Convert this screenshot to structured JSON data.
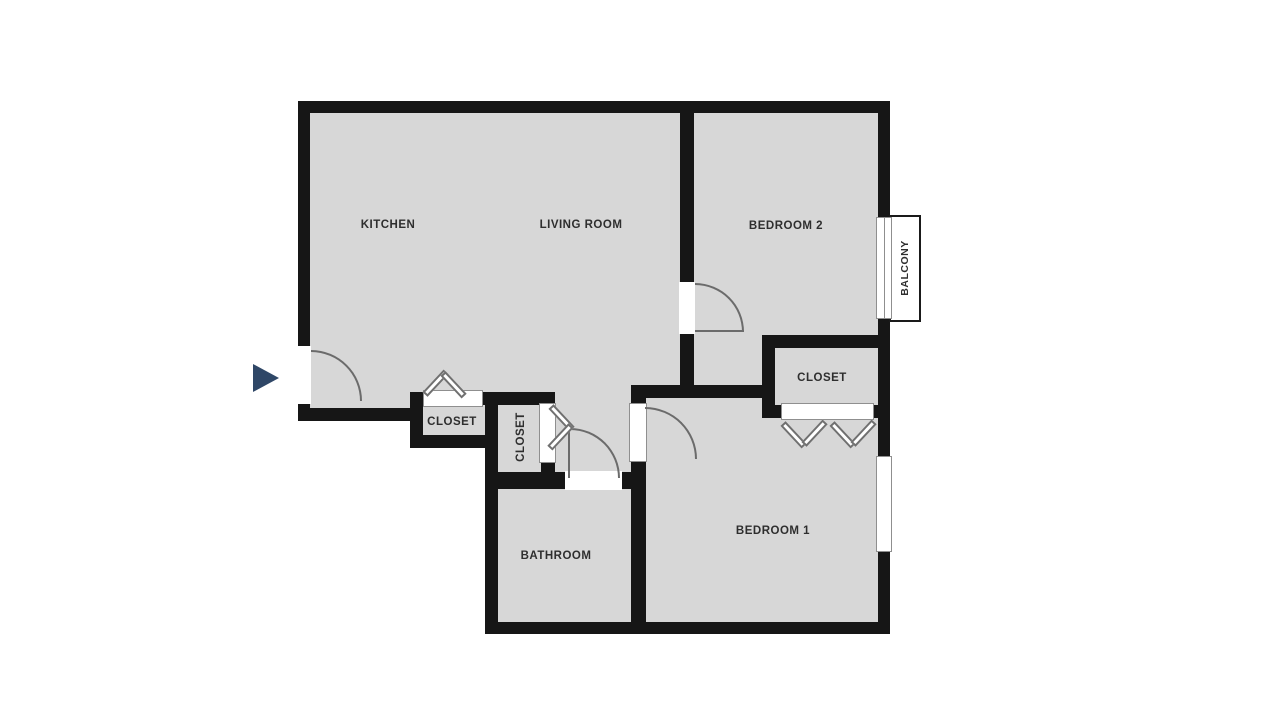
{
  "floor_plan": {
    "type": "apartment-floor-plan",
    "colors": {
      "background": "#ffffff",
      "wall": "#161616",
      "floor": "#d7d7d7",
      "door_arc": "#6b6b6b",
      "opening_outline": "#8f8f8f",
      "entry_arrow": "#2f4767",
      "label_text": "#2e2e2e"
    },
    "labels": {
      "kitchen": "KITCHEN",
      "living_room": "LIVING ROOM",
      "bedroom_2": "BEDROOM 2",
      "bedroom_1": "BEDROOM 1",
      "bathroom": "BATHROOM",
      "balcony": "BALCONY",
      "closet_bedroom": "CLOSET",
      "closet_hall_1": "CLOSET",
      "closet_hall_2": "CLOSET"
    },
    "features": {
      "entry_marker": "entry-arrow",
      "doors": [
        "entry-door",
        "bedroom-2-door",
        "bedroom-1-door",
        "bathroom-door",
        "balcony-sliding-door"
      ],
      "bifold_doors": [
        "hall-closet-1-bifold",
        "hall-closet-2-bifold",
        "bedroom-1-closet-bifold"
      ],
      "windows": [
        "bedroom-1-window"
      ]
    }
  }
}
